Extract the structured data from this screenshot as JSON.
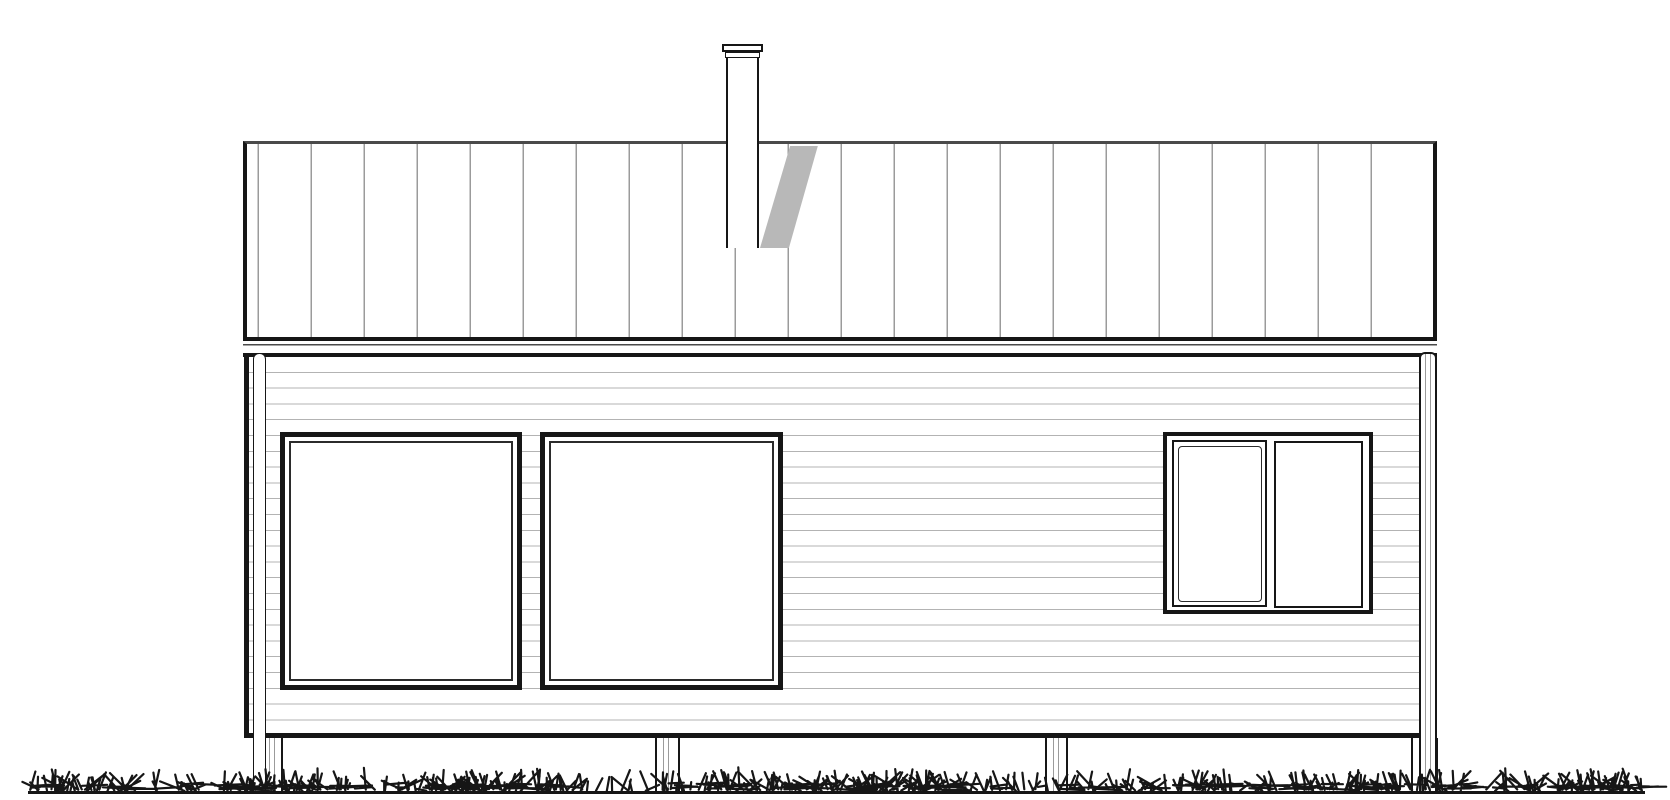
{
  "colors": {
    "background": "#ffffff",
    "ink": "#161616",
    "ink2": "#2b2b2b",
    "edge_gray": "#4a4a4a",
    "seam_gray": "#9b9b9b",
    "siding_gray": "#b3b3b3",
    "shadow_gray": "#b8b8b8"
  },
  "canvas": {
    "w": 1670,
    "h": 800
  },
  "roof": {
    "x": 243,
    "y": 141,
    "w": 1194,
    "h": 200,
    "seam_pitch": 53,
    "seam_offset": -41
  },
  "chimney": {
    "cap_outer": {
      "x": 722,
      "y": 44,
      "w": 41,
      "h": 8
    },
    "cap_inner": {
      "x": 725,
      "y": 52,
      "w": 35,
      "h": 6
    },
    "body": {
      "x": 726,
      "y": 57,
      "w": 33,
      "h": 191
    },
    "shadow": {
      "x": 760,
      "y": 146,
      "w": 59,
      "h": 102
    }
  },
  "fascia": {
    "x": 243,
    "y": 341,
    "w": 1194,
    "h": 16
  },
  "wall": {
    "x": 244,
    "y": 357,
    "w": 1180,
    "h": 381,
    "siding_pitch": 15.8
  },
  "windows": {
    "left": {
      "x": 280,
      "y": 432,
      "w": 242,
      "h": 258
    },
    "middle": {
      "x": 540,
      "y": 432,
      "w": 243,
      "h": 258
    },
    "right": {
      "frame": {
        "x": 1163,
        "y": 432,
        "w": 210,
        "h": 182
      },
      "sash_opening": {
        "x": 1172,
        "y": 440,
        "w": 95,
        "h": 167
      },
      "sash_fixed": {
        "x": 1274,
        "y": 441,
        "w": 89,
        "h": 167
      }
    }
  },
  "downspouts": {
    "left": {
      "x": 253,
      "y": 353,
      "w": 13,
      "h": 439
    },
    "right": {
      "x": 1419,
      "y": 352,
      "w": 18,
      "h": 440
    }
  },
  "posts": [
    {
      "x": 261,
      "y": 738,
      "w": 22,
      "h": 54
    },
    {
      "x": 655,
      "y": 738,
      "w": 25,
      "h": 54
    },
    {
      "x": 1045,
      "y": 738,
      "w": 23,
      "h": 54
    },
    {
      "x": 1411,
      "y": 738,
      "w": 27,
      "h": 54
    }
  ],
  "ground": {
    "x": 28,
    "y": 791,
    "w": 1617,
    "h": 3
  },
  "grass": {
    "seed": 1337,
    "count": 980,
    "x_min": 30,
    "x_max": 1643,
    "baseline": 791,
    "max_height": 28
  }
}
